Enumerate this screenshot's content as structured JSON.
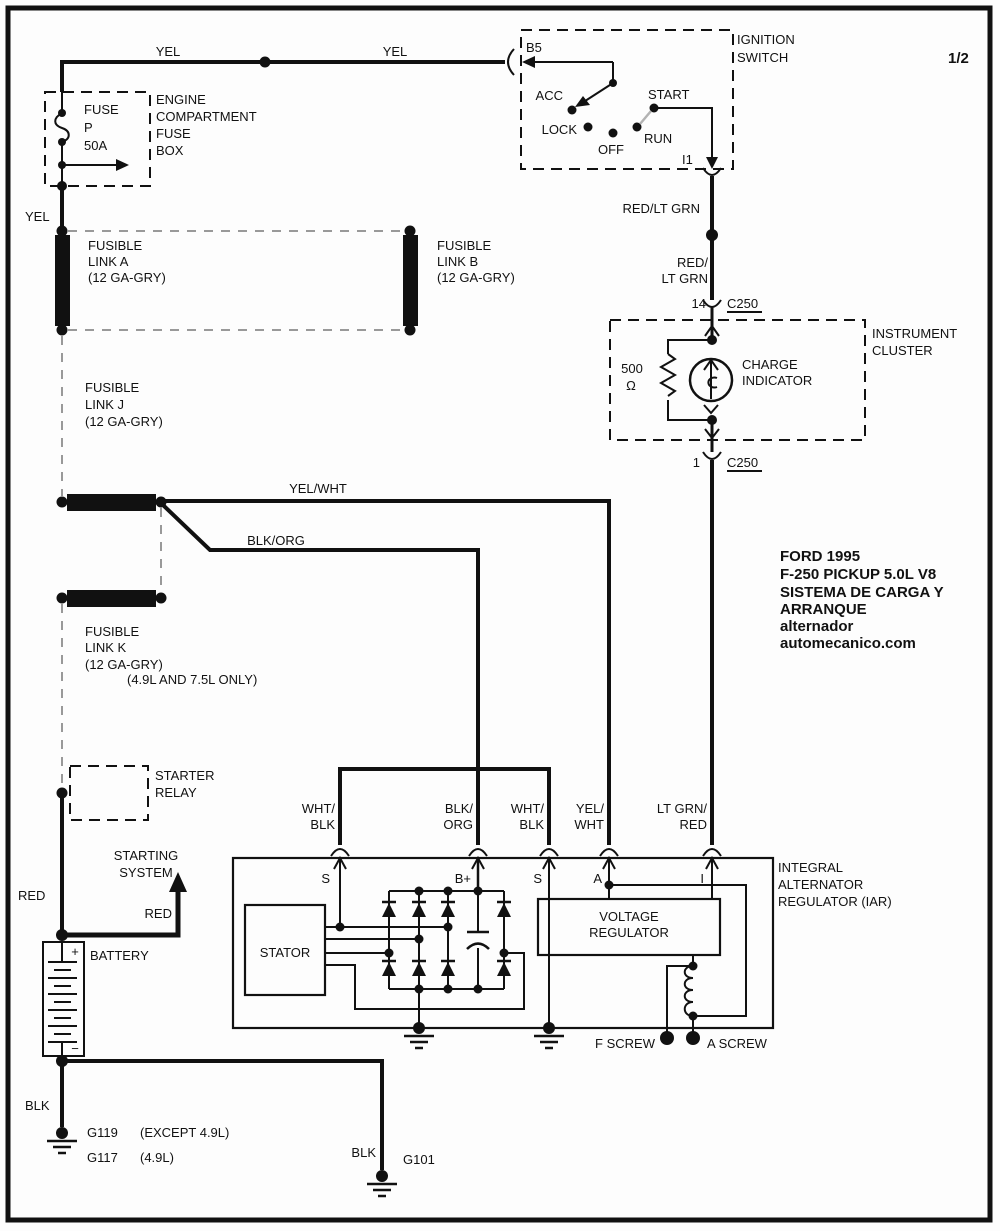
{
  "colors": {
    "ink": "#111111",
    "background": "#fdfdfd",
    "dash_grey": "#999999"
  },
  "page": {
    "sheet": "1/2"
  },
  "top_circuit": {
    "yel_left": "YEL",
    "yel_right": "YEL",
    "yel_below_fuse": "YEL"
  },
  "fuse_box": {
    "name_lines": [
      "ENGINE",
      "COMPARTMENT",
      "FUSE",
      "BOX"
    ],
    "fuse_lines": [
      "FUSE",
      "P",
      "50A"
    ]
  },
  "ignition_switch": {
    "title_lines": [
      "IGNITION",
      "SWITCH"
    ],
    "pin_in": "B5",
    "pin_out": "I1",
    "acc": "ACC",
    "lock": "LOCK",
    "off": "OFF",
    "run": "RUN",
    "start": "START"
  },
  "links": {
    "a": {
      "l1": "FUSIBLE",
      "l2": "LINK A",
      "l3": "(12 GA-GRY)"
    },
    "b": {
      "l1": "FUSIBLE",
      "l2": "LINK B",
      "l3": "(12 GA-GRY)"
    },
    "j": {
      "l1": "FUSIBLE",
      "l2": "LINK J",
      "l3": "(12 GA-GRY)"
    },
    "k": {
      "l1": "FUSIBLE",
      "l2": "LINK K",
      "l3": "(12 GA-GRY)",
      "note": "(4.9L AND 7.5L ONLY)"
    }
  },
  "mid_wires": {
    "red_ltgrn": "RED/LT GRN",
    "red_slash": "RED/",
    "lt_grn": "LT GRN",
    "yel_wht": "YEL/WHT",
    "blk_org": "BLK/ORG"
  },
  "c250_top": {
    "pin": "14",
    "name": "C250"
  },
  "c250_bottom": {
    "pin": "1",
    "name": "C250"
  },
  "cluster": {
    "title_l1": "INSTRUMENT",
    "title_l2": "CLUSTER",
    "res_value": "500",
    "res_unit": "Ω",
    "lamp_l1": "CHARGE",
    "lamp_l2": "INDICATOR"
  },
  "left_branch": {
    "starter_l1": "STARTER",
    "starter_l2": "RELAY",
    "starting_l1": "STARTING",
    "starting_l2": "SYSTEM",
    "red_main": "RED",
    "red_arrow": "RED",
    "battery": "BATTERY",
    "plus": "+",
    "minus": "−",
    "blk_left": "BLK",
    "blk_right": "BLK",
    "g119": "G119",
    "g119_note": "(EXCEPT 4.9L)",
    "g117": "G117",
    "g117_note": "(4.9L)",
    "g101": "G101"
  },
  "iar": {
    "title_l1": "INTEGRAL",
    "title_l2": "ALTERNATOR",
    "title_l3": "REGULATOR (IAR)",
    "term_s1": "S",
    "term_bplus": "B+",
    "term_s2": "S",
    "term_a": "A",
    "term_i": "I",
    "stator": "STATOR",
    "reg_l1": "VOLTAGE",
    "reg_l2": "REGULATOR",
    "f_screw": "F SCREW",
    "a_screw": "A SCREW",
    "w1a": "WHT/",
    "w1b": "BLK",
    "w2a": "BLK/",
    "w2b": "ORG",
    "w3a": "WHT/",
    "w3b": "BLK",
    "w4a": "YEL/",
    "w4b": "WHT",
    "w5a": "LT GRN/",
    "w5b": "RED"
  },
  "title_block": {
    "l1": "FORD 1995",
    "l2": "F-250 PICKUP 5.0L V8",
    "l3": "SISTEMA DE CARGA Y",
    "l4": "ARRANQUE",
    "l5": "alternador",
    "l6": "automecanico.com"
  }
}
